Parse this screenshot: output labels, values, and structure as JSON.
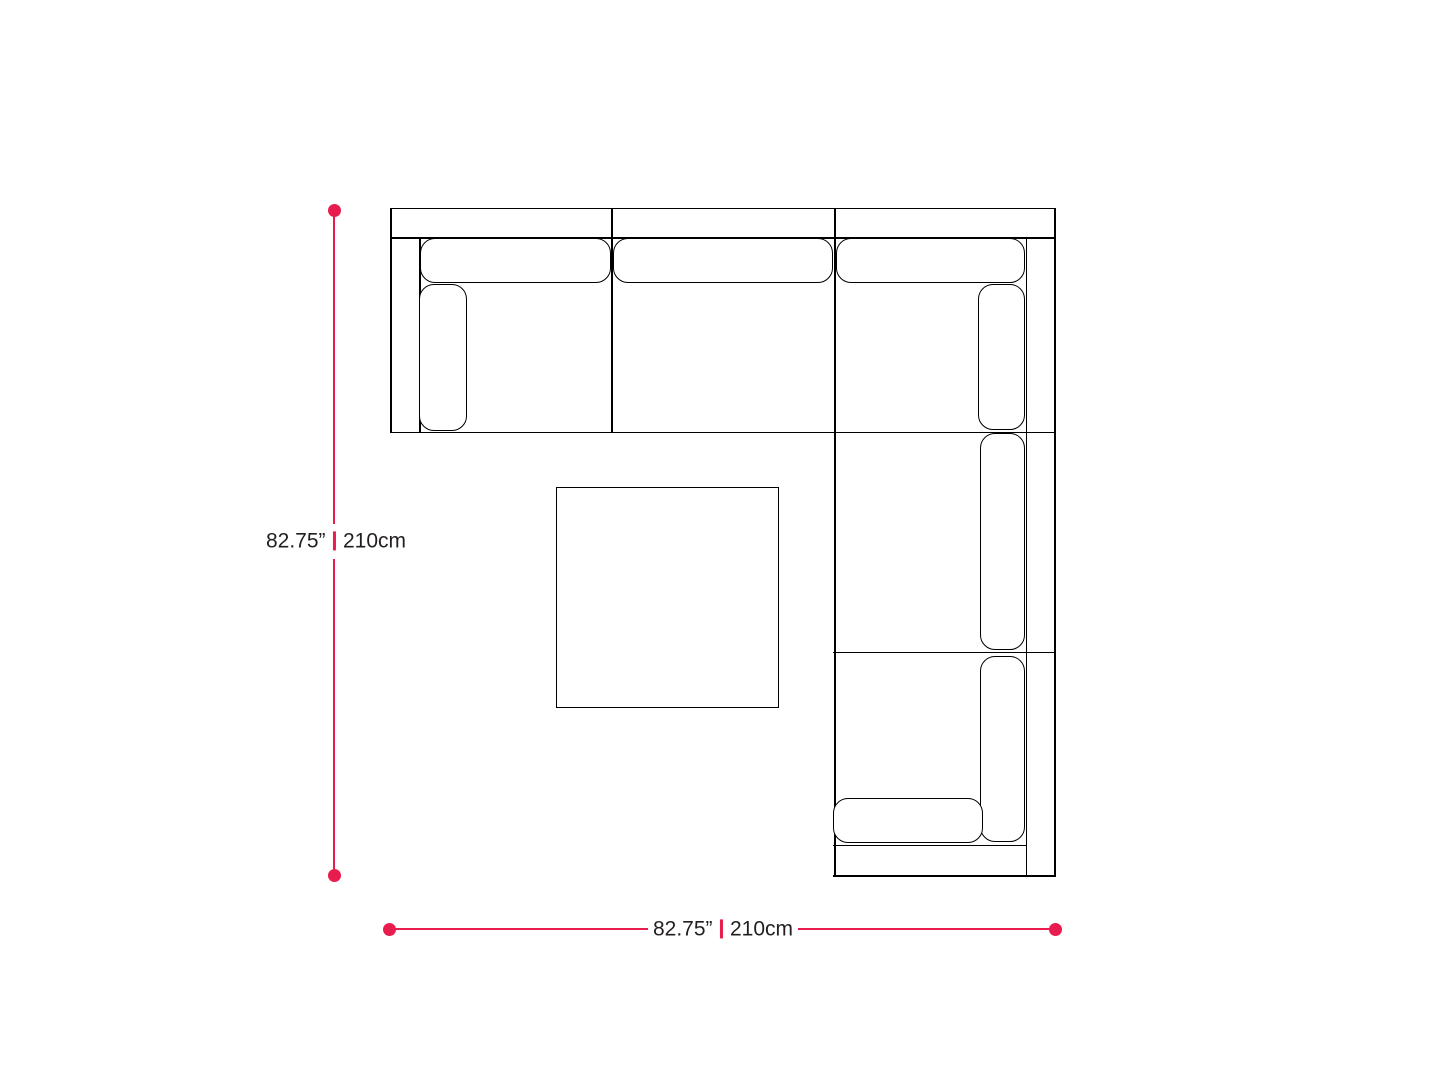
{
  "diagram": {
    "kind": "sectional-sofa-top-view-dimension-diagram",
    "vertical_dimension": {
      "inches": "82.75”",
      "cm": "210cm"
    },
    "horizontal_dimension": {
      "inches": "82.75”",
      "cm": "210cm"
    },
    "colors": {
      "dimension_accent": "#E81D4D",
      "outline": "#000000",
      "label_text": "#231F20",
      "background": "#FFFFFF"
    }
  }
}
